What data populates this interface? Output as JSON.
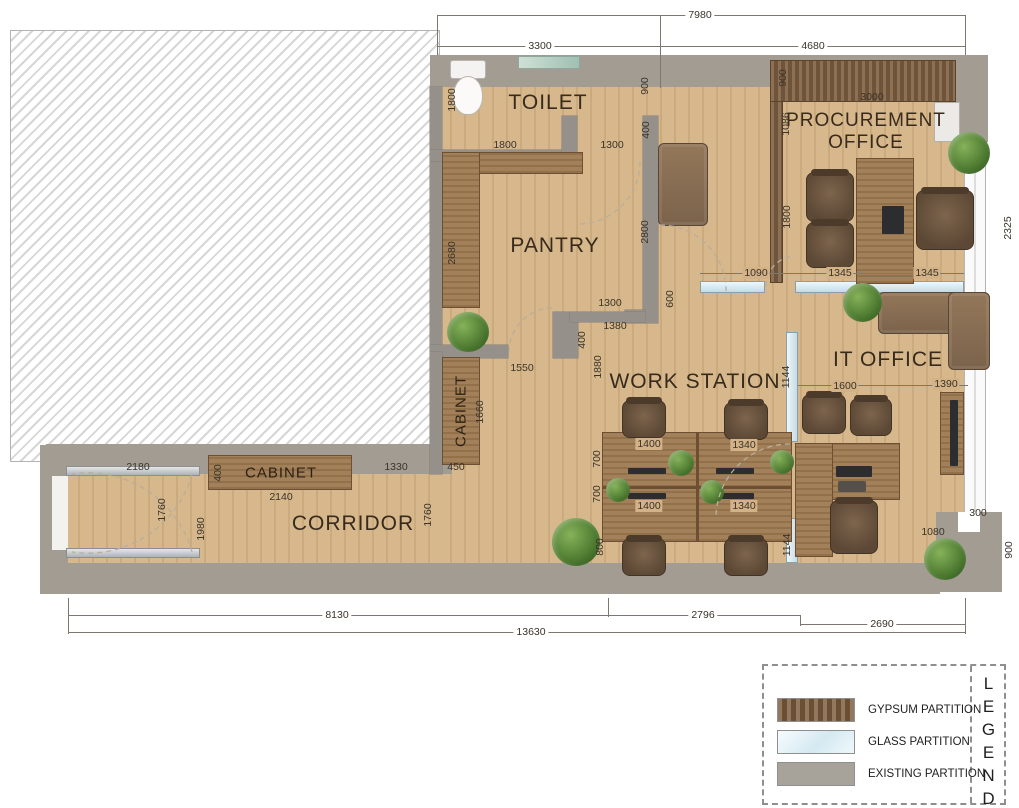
{
  "rooms": {
    "toilet": "TOILET",
    "pantry": "PANTRY",
    "procurement_line1": "PROCUREMENT",
    "procurement_line2": "OFFICE",
    "it_office": "IT OFFICE",
    "work_station": "WORK STATION",
    "corridor": "CORRIDOR",
    "cabinet_corridor": "CABINET",
    "cabinet_pantry": "CABINET"
  },
  "dims": [
    "7980",
    "3300",
    "4680",
    "1800",
    "900",
    "1800",
    "1300",
    "400",
    "900",
    "3000",
    "1086",
    "2680",
    "2800",
    "1800",
    "1090",
    "1345",
    "1345",
    "1300",
    "1380",
    "400",
    "600",
    "1550",
    "1660",
    "1880",
    "1600",
    "1390",
    "1144",
    "1144",
    "1400",
    "1340",
    "700",
    "700",
    "1400",
    "1340",
    "800",
    "1080",
    "300",
    "2180",
    "400",
    "2140",
    "1330",
    "450",
    "1760",
    "1980",
    "1760",
    "8130",
    "2796",
    "2690",
    "13630",
    "2325",
    "900"
  ],
  "legend": {
    "title": "LEGENDS",
    "items": [
      {
        "label": "GYPSUM PARTITION",
        "color": "#7a5a3c"
      },
      {
        "label": "GLASS PARTITION",
        "color": "#d7eaf2"
      },
      {
        "label": "EXISTING PARTITION",
        "color": "#a8a39a"
      }
    ]
  },
  "colors": {
    "floor_wood": "#d2b286",
    "wall_existing": "#a29c93",
    "partition_gypsum": "#7a5a3c",
    "partition_glass": "#d7eaf2"
  }
}
